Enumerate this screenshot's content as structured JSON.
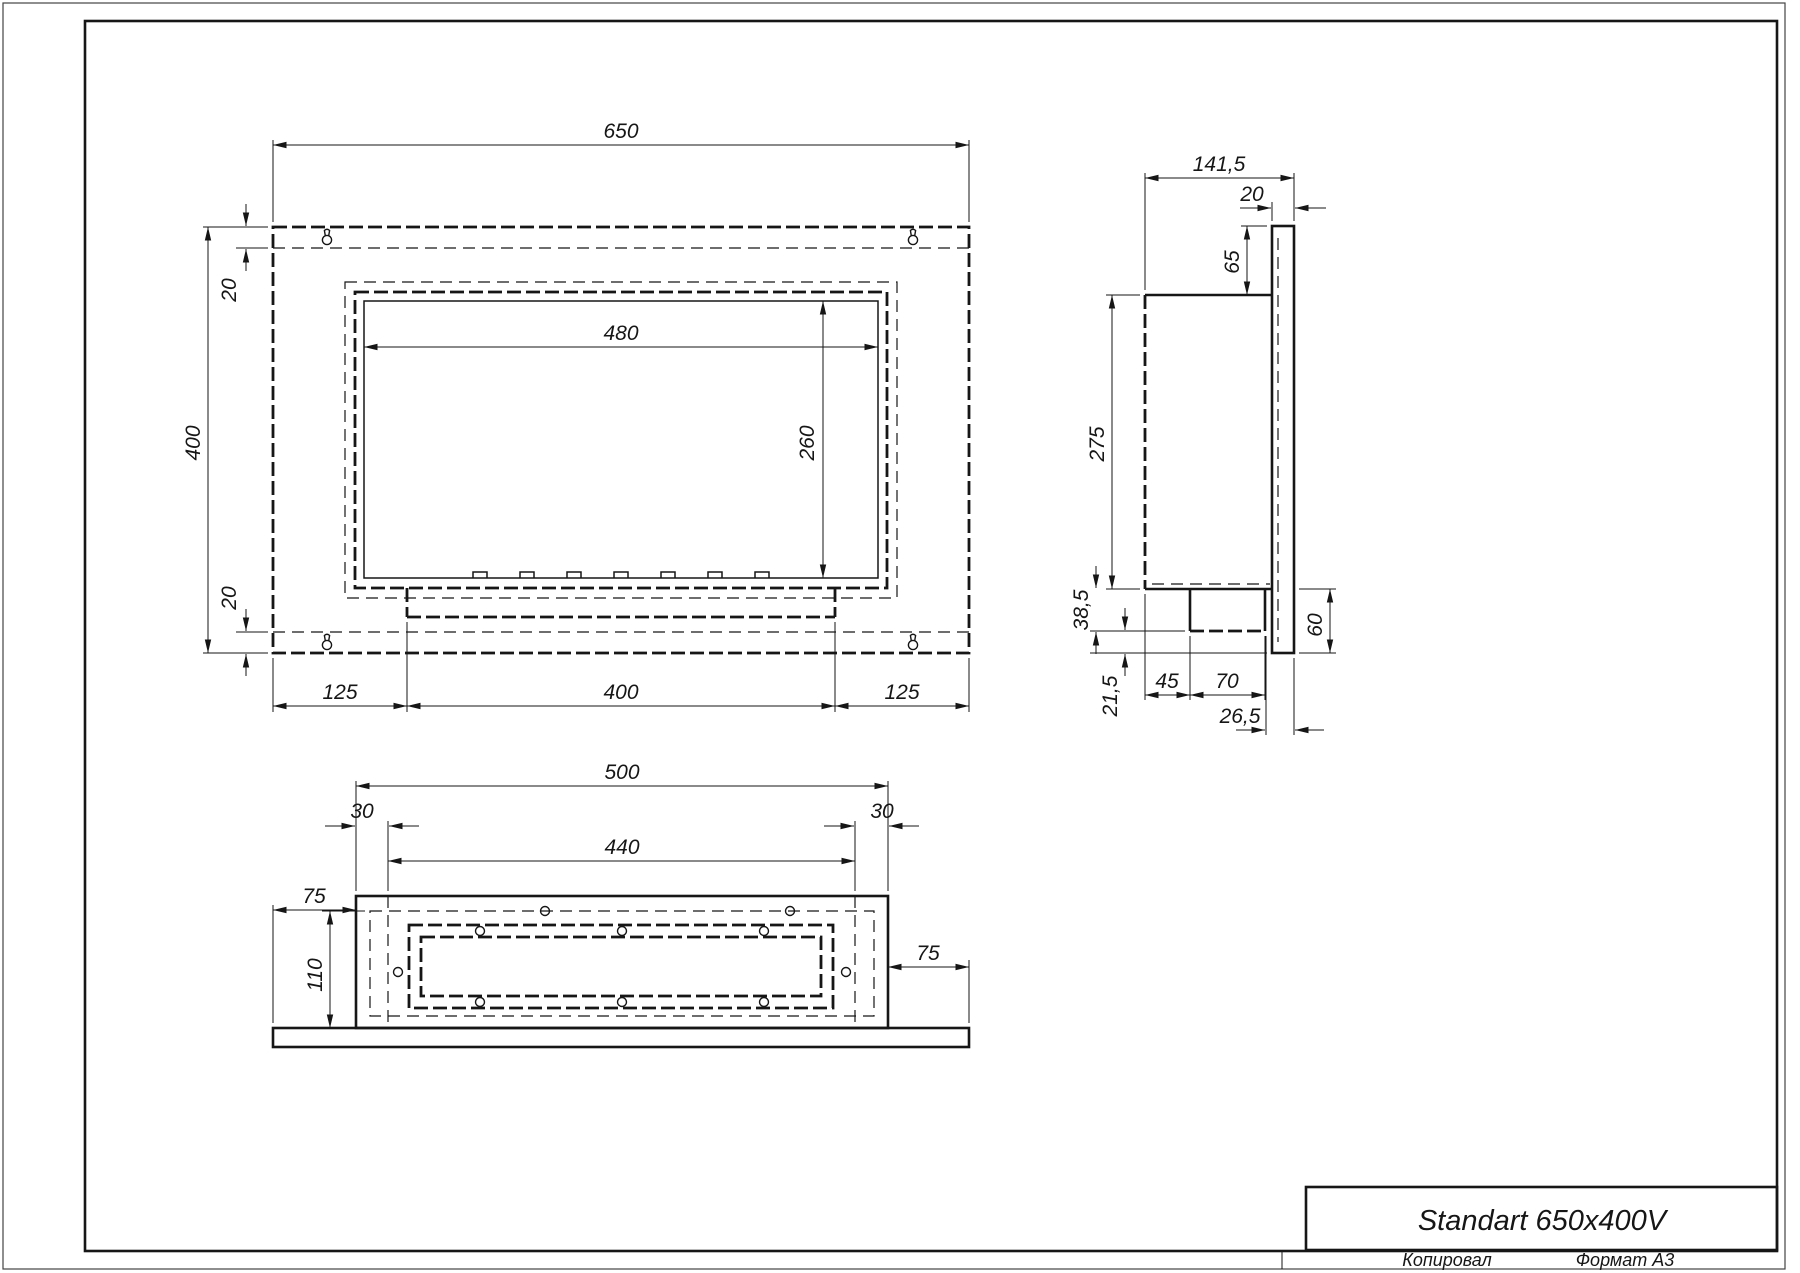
{
  "title_block": {
    "product": "Standart 650x400V"
  },
  "footer": {
    "copied": "Копировал",
    "format": "Формат A3"
  },
  "views": {
    "front": {
      "width": "650",
      "height": "400",
      "offset_top": "20",
      "offset_bottom": "20",
      "opening_width": "480",
      "opening_height": "260",
      "foot_left": "125",
      "foot_center": "400",
      "foot_right": "125"
    },
    "side": {
      "depth": "141,5",
      "flange_thickness": "20",
      "top_inset": "65",
      "body_height": "275",
      "burner_height": "38,5",
      "bottom_lip": "21,5",
      "burner_offset": "45",
      "burner_depth": "70",
      "spigot_offset": "26,5",
      "flange_bottom": "60"
    },
    "bottom": {
      "width": "500",
      "lip_left": "30",
      "inner_width": "440",
      "lip_right": "30",
      "flange_overhang_left": "75",
      "inner_depth": "110",
      "flange_overhang_right": "75"
    }
  }
}
